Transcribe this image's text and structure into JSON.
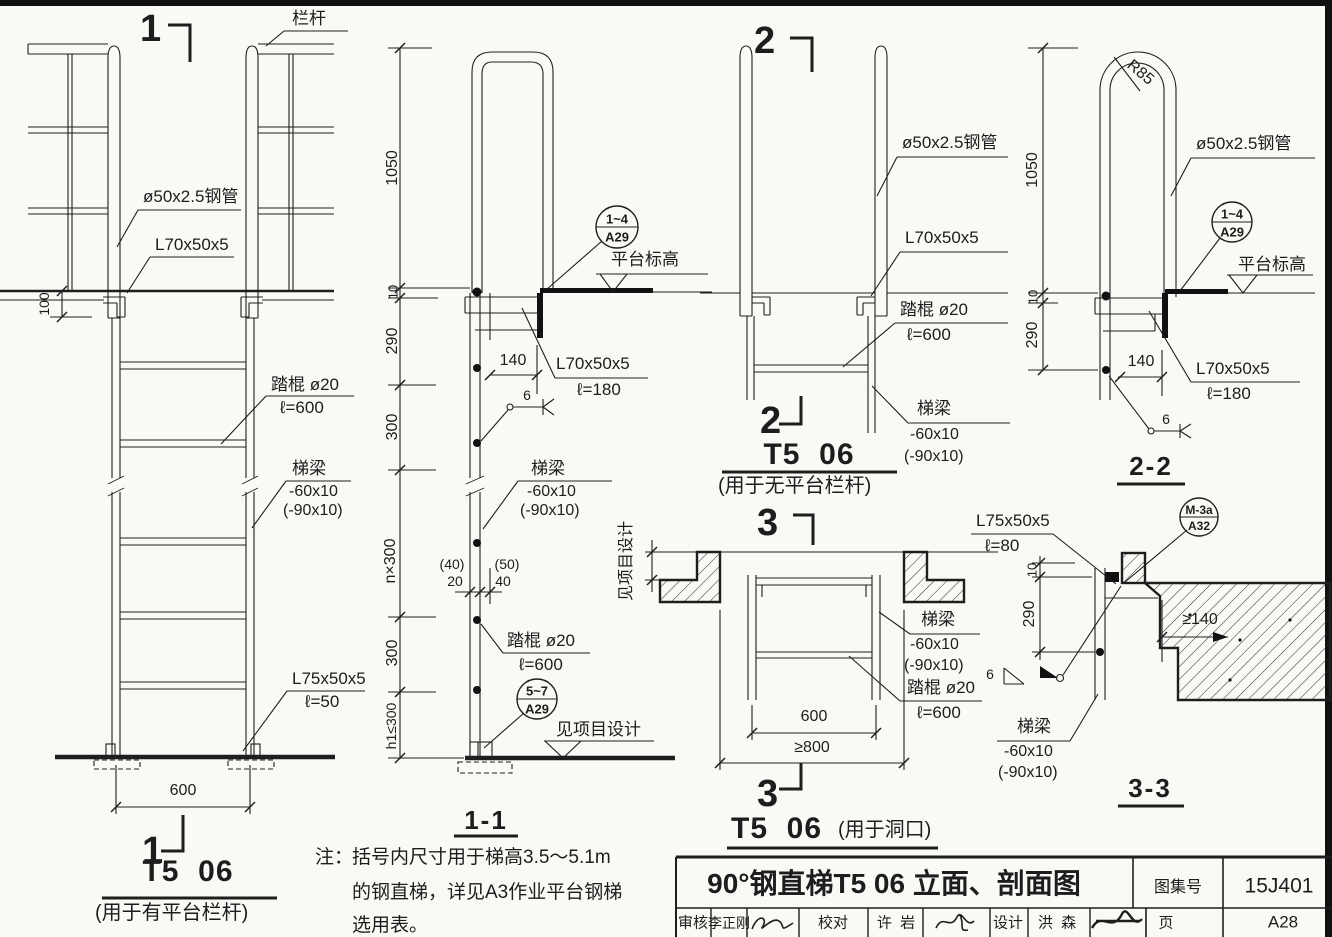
{
  "elev1": {
    "marker_top": "1",
    "marker_bottom": "1",
    "railing": "栏杆",
    "pipe": "ø50x2.5钢管",
    "angle": "L70x50x5",
    "dim_100": "100",
    "rung_label": "踏棍 ø20",
    "rung_len": "ℓ=600",
    "stringer_label": "梯梁",
    "stringer_size": "-60x10",
    "stringer_size_alt": "(-90x10)",
    "base_angle": "L75x50x5",
    "base_angle_len": "ℓ=50",
    "dim_600": "600",
    "title": "T5  06",
    "subtitle": "(用于有平台栏杆)"
  },
  "sec11": {
    "dims": {
      "d1050": "1050",
      "d10": "10",
      "d290": "290",
      "d300a": "300",
      "dn300": "n×300",
      "d300b": "300",
      "dh1": "h1≤300",
      "d140": "140",
      "d40": "(40)",
      "d20": "20",
      "d50": "(50)",
      "d40b": "40",
      "weld6": "6"
    },
    "angle_label": "L70x50x5",
    "angle_len": "ℓ=180",
    "stringer_label": "梯梁",
    "stringer_size": "-60x10",
    "stringer_size_alt": "(-90x10)",
    "rung_label": "踏棍 ø20",
    "rung_len": "ℓ=600",
    "platform_level": "平台标高",
    "project_level": "见项目设计",
    "bubble_top": {
      "num": "1~4",
      "sheet": "A29"
    },
    "bubble_bottom": {
      "num": "5~7",
      "sheet": "A29"
    },
    "title": "1-1"
  },
  "note": {
    "prefix": "注：",
    "line1": "括号内尺寸用于梯高3.5～5.1m",
    "line2": "的钢直梯，详见A3作业平台钢梯",
    "line3": "选用表。"
  },
  "sec2": {
    "marker_top": "2",
    "marker_bottom": "2",
    "pipe": "ø50x2.5钢管",
    "angle": "L70x50x5",
    "rung_label": "踏棍 ø20",
    "rung_len": "ℓ=600",
    "stringer_label": "梯梁",
    "stringer_size": "-60x10",
    "stringer_size_alt": "(-90x10)",
    "title": "T5  06",
    "subtitle": "(用于无平台栏杆)"
  },
  "sec3": {
    "marker_top": "3",
    "marker_bottom": "3",
    "project_design": "见项目设计",
    "stringer_label": "梯梁",
    "stringer_size": "-60x10",
    "stringer_size_alt": "(-90x10)",
    "rung_label": "踏棍 ø20",
    "rung_len": "ℓ=600",
    "dim_600": "600",
    "dim_800": "≥800",
    "title": "T5  06",
    "subtitle": "(用于洞口)"
  },
  "sec22": {
    "dims": {
      "d1050": "1050",
      "d10": "10",
      "d290": "290",
      "d140": "140",
      "weld6": "6",
      "r85": "R85"
    },
    "pipe": "ø50x2.5钢管",
    "angle_label": "L70x50x5",
    "angle_len": "ℓ=180",
    "platform_level": "平台标高",
    "bubble": {
      "num": "1~4",
      "sheet": "A29"
    },
    "title": "2-2"
  },
  "sec33": {
    "dims": {
      "d10": "10",
      "d290": "290",
      "d140": "≥140",
      "weld6": "6"
    },
    "angle_label": "L75x50x5",
    "angle_len": "ℓ=80",
    "stringer_label": "梯梁",
    "stringer_size": "-60x10",
    "stringer_size_alt": "(-90x10)",
    "bubble": {
      "num": "M-3a",
      "sheet": "A32"
    },
    "title": "3-3"
  },
  "titleblock": {
    "title": "90°钢直梯T5 06 立面、剖面图",
    "atlas_label": "图集号",
    "atlas_no": "15J401",
    "page_label": "页",
    "page_no": "A28",
    "review_label": "审核",
    "reviewer": "李正刚",
    "check_label": "校对",
    "checker": "许  岩",
    "design_label": "设计",
    "designer": "洪  森"
  }
}
